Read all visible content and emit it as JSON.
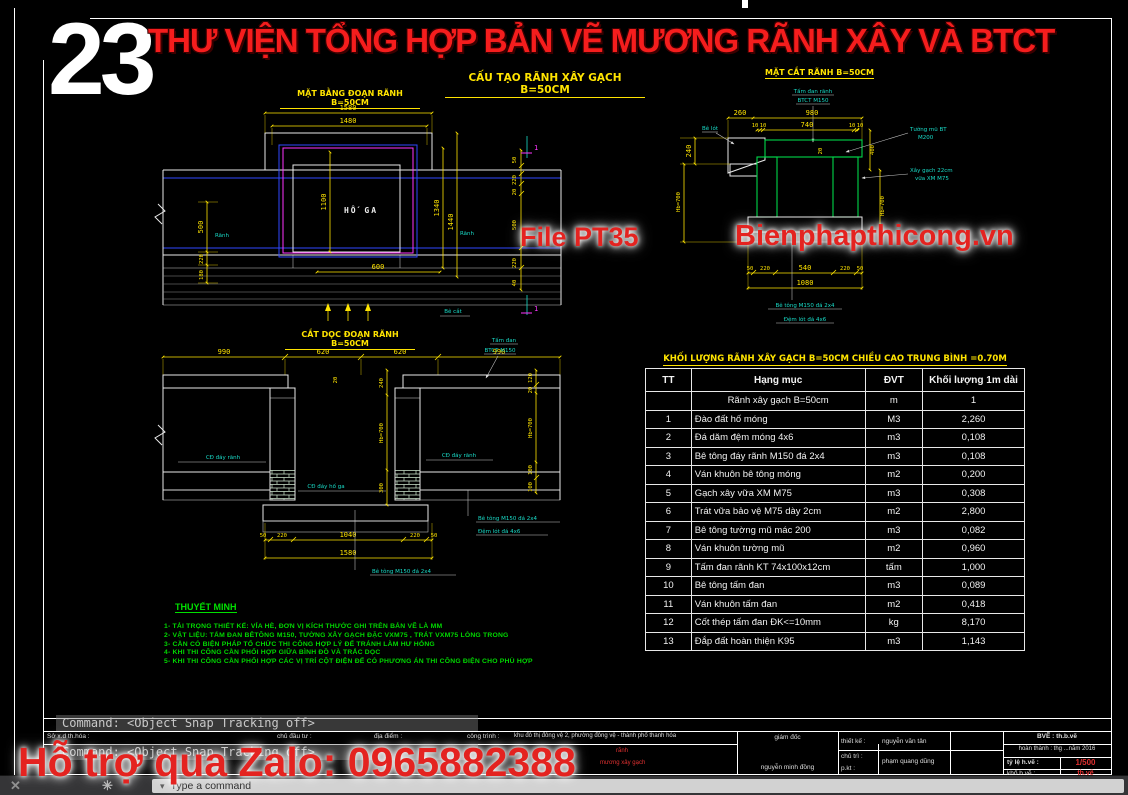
{
  "sheet": {
    "number": "23",
    "title": "THƯ VIỆN TỔNG HỢP BẢN VẼ MƯƠNG RÃNH XÂY VÀ BTCT",
    "main_heading": "CẤU TẠO RÃNH XÂY GẠCH  B=50CM"
  },
  "watermarks": {
    "file": "File PT35",
    "site": "Bienphapthicong.vn",
    "zalo": "Hỗ trợ qua Zalo: 0965882388"
  },
  "plan": {
    "title": "MẶT BẰNG ĐOẠN RÃNH B=50CM",
    "labels": {
      "manhole": "HỐ GA",
      "ranh_left": "Rãnh",
      "ranh_right": "Rãnh",
      "be_cat": "Bê cắt",
      "section": "1"
    },
    "dims": {
      "w1580": "1580",
      "w1480": "1480",
      "h1100": "1100",
      "w600": "600",
      "l500": "500",
      "l220": "220",
      "l180": "180",
      "r1340": "1340",
      "r1440": "1440",
      "rr50": "50",
      "rr220a": "220",
      "rr20": "20",
      "rr500": "500",
      "rr220b": "220",
      "rr40": "40"
    }
  },
  "cross": {
    "title": "MẶT CẮT RÃNH B=50CM",
    "dims": {
      "t260": "260",
      "t980": "980",
      "t10a": "10",
      "t10b": "10",
      "t740": "740",
      "t10c": "10",
      "t10d": "10",
      "s20": "20",
      "l240": "240",
      "lhb": "Hb=700",
      "r400": "400",
      "rhb": "Hb=700",
      "b50a": "50",
      "b220a": "220",
      "b540": "540",
      "b220b": "220",
      "b50b": "50",
      "b1080": "1080"
    },
    "labels": {
      "slab1": "Tấm đan rãnh",
      "slab2": "BTCT M150",
      "belot": "Bê lót",
      "wall1": "Tường mũ BT",
      "wall2": "M200",
      "brick1": "Xây gạch 22cm",
      "brick2": "vữa XM M75",
      "found1": "Bê tông M150 đá 2x4",
      "found2": "Đệm lót đá 4x6"
    }
  },
  "longsec": {
    "title": "CẮT DỌC ĐOẠN RÃNH B=50CM",
    "dims": {
      "t990a": "990",
      "t620a": "620",
      "t620b": "620",
      "t990b": "990",
      "v20": "20",
      "v240": "240",
      "vhb": "Hb=700",
      "v300": "300",
      "r120": "120",
      "r20": "20",
      "rhb": "Hb=700",
      "r100a": "100",
      "r100b": "100",
      "b50a": "50",
      "b220a": "220",
      "b1040": "1040",
      "b220b": "220",
      "b50b": "50",
      "b1580": "1580"
    },
    "labels": {
      "slab1": "Tấm đan",
      "slab2": "BTCT M150",
      "cd_ranh_left": "CĐ đáy rãnh",
      "cd_ranh_right": "CĐ đáy rãnh",
      "cd_hoga": "CĐ đáy hố ga",
      "bt1": "Bê tông M150 đá 2x4",
      "dem": "Đệm lót đá 4x6",
      "bt2": "Bê tông M150 đá 2x4"
    }
  },
  "notes": {
    "title": "THUYẾT MINH",
    "lines": [
      "1- TẢI TRỌNG THIẾT KẾ: VỈA HÈ, ĐƠN VỊ KÍCH THƯỚC GHI TRÊN BẢN VẼ LÀ MM",
      "2- VẬT LIỆU: TẤM ĐAN BÊTÔNG M150, TƯỜNG XÂY GẠCH ĐẶC VXM75 , TRÁT VXM75 LÒNG TRONG",
      "3- CẦN CÓ BIỆN PHÁP TỔ CHỨC THI CÔNG HỢP LÝ ĐỂ TRÁNH LÀM HƯ HỎNG",
      "4- KHI THI CÔNG CẦN PHỐI HỢP GIỮA BÌNH ĐỒ VÀ TRẮC DỌC",
      "5- KHI THI CÔNG CẦN PHỐI HỢP CÁC VỊ TRÍ CỘT ĐIỆN ĐỂ CÓ PHƯƠNG ÁN THI CÔNG ĐIỆN CHO PHÙ HỢP"
    ]
  },
  "table": {
    "title": "KHỐI LƯỢNG RÃNH XÂY GẠCH B=50CM  CHIỀU CAO TRUNG BÌNH =0.70M",
    "headers": [
      "TT",
      "Hạng mục",
      "ĐVT",
      "Khối lượng 1m dài"
    ],
    "rows": [
      [
        "",
        "Rãnh xây gạch B=50cm",
        "m",
        "1"
      ],
      [
        "1",
        "Đào đất hố móng",
        "M3",
        "2,260"
      ],
      [
        "2",
        "Đá dăm đệm móng 4x6",
        "m3",
        "0,108"
      ],
      [
        "3",
        "Bê tông đáy rãnh M150 đá 2x4",
        "m3",
        "0,108"
      ],
      [
        "4",
        "Ván khuôn bê tông móng",
        "m2",
        "0,200"
      ],
      [
        "5",
        "Gạch xây vữa XM M75",
        "m3",
        "0,308"
      ],
      [
        "6",
        "Trát vữa bảo vệ  M75  dày 2cm",
        "m2",
        "2,800"
      ],
      [
        "7",
        "Bê tông tường mũ mác 200",
        "m3",
        "0,082"
      ],
      [
        "8",
        "Ván khuôn tường mũ",
        "m2",
        "0,960"
      ],
      [
        "9",
        "Tấm đan rãnh KT 74x100x12cm",
        "tấm",
        "1,000"
      ],
      [
        "10",
        "Bê tông tấm đan",
        "m3",
        "0,089"
      ],
      [
        "11",
        "Ván khuôn  tấm đan",
        "m2",
        "0,418"
      ],
      [
        "12",
        "Cốt thép tấm đan ĐK<=10mm",
        "kg",
        "8,170"
      ],
      [
        "13",
        "Đắp đất hoàn thiện K95",
        "m3",
        "1,143"
      ]
    ]
  },
  "command": {
    "line1": "Command:  <Object Snap Tracking off>",
    "line2": "Command:  <Object Snap Tracking off>",
    "input": "Type a command"
  },
  "title_block": {
    "c1": "Sở x.d th.hóa :",
    "c2": "chủ đầu tư :",
    "c3": "địa điểm :",
    "c4": "công trình :",
    "project": "khu đô thị đông vệ 2, phường đông vệ - thành phố thanh hóa",
    "red_note_1": "rãnh",
    "red_note_2": "mương xây gạch",
    "director_label": "giám đốc",
    "director_name": "nguyễn minh đồng",
    "design_label": "thiết kế :",
    "design_name": "nguyễn văn tân",
    "lead_label": "chủ trì :",
    "lead_label2": "p.kt :",
    "lead_name": "phạm quang dũng",
    "drawing_label": "BVẼ : th.b.vẽ",
    "finish_label": "hoàn thành : thg ...năm 2016",
    "scale_label": "tỷ lệ h.vẽ :",
    "scale_value": "1/500",
    "size_label": "khổ b.vẽ :",
    "size_value": "th.vẽ"
  }
}
